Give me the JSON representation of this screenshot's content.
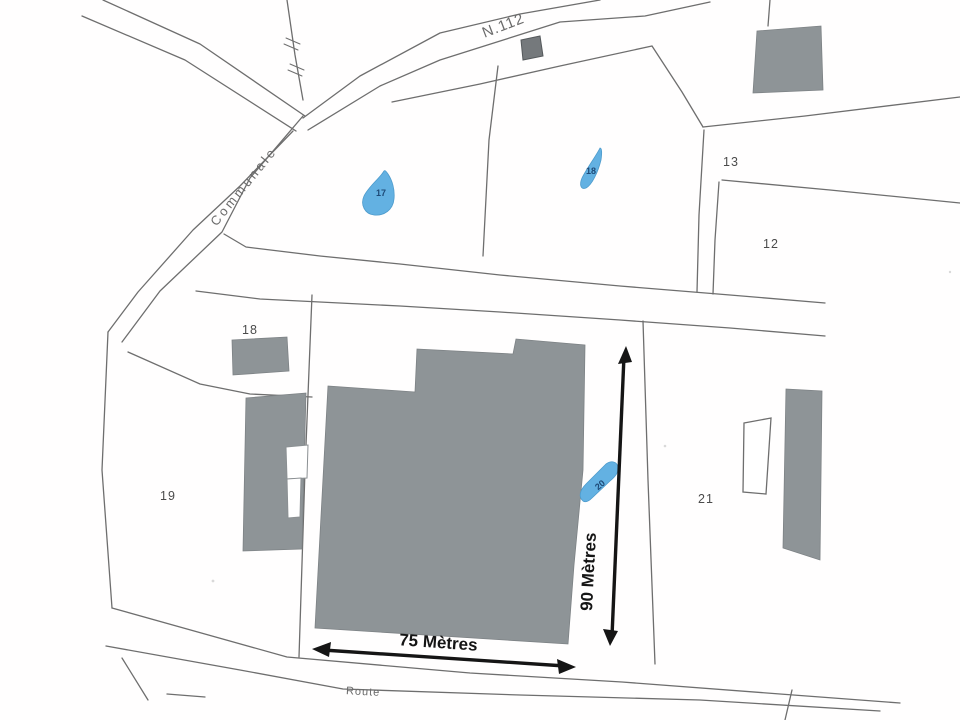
{
  "plan": {
    "road_labels": {
      "national": "N.112",
      "communal": "Communale",
      "route": "Route"
    },
    "parcel_labels": {
      "p12": "12",
      "p13": "13",
      "p18": "18",
      "p19": "19",
      "p21": "21"
    },
    "water_point_labels": {
      "w17": "17",
      "w18": "18",
      "w20": "20"
    },
    "dimensions": {
      "width": "75 Mètres",
      "height": "90 Mètres"
    },
    "colors": {
      "building_fill": "#8e9497",
      "building_fill_dark": "#75797c",
      "water_blue": "#63b1e2",
      "water_outline": "#4d9bcc",
      "water_text": "#1e4a77",
      "line": "#6e6e6e",
      "label": "#4b4b4b",
      "arrow": "#151515",
      "road_text": "#6a6a6a",
      "paper": "#fffefe"
    }
  }
}
